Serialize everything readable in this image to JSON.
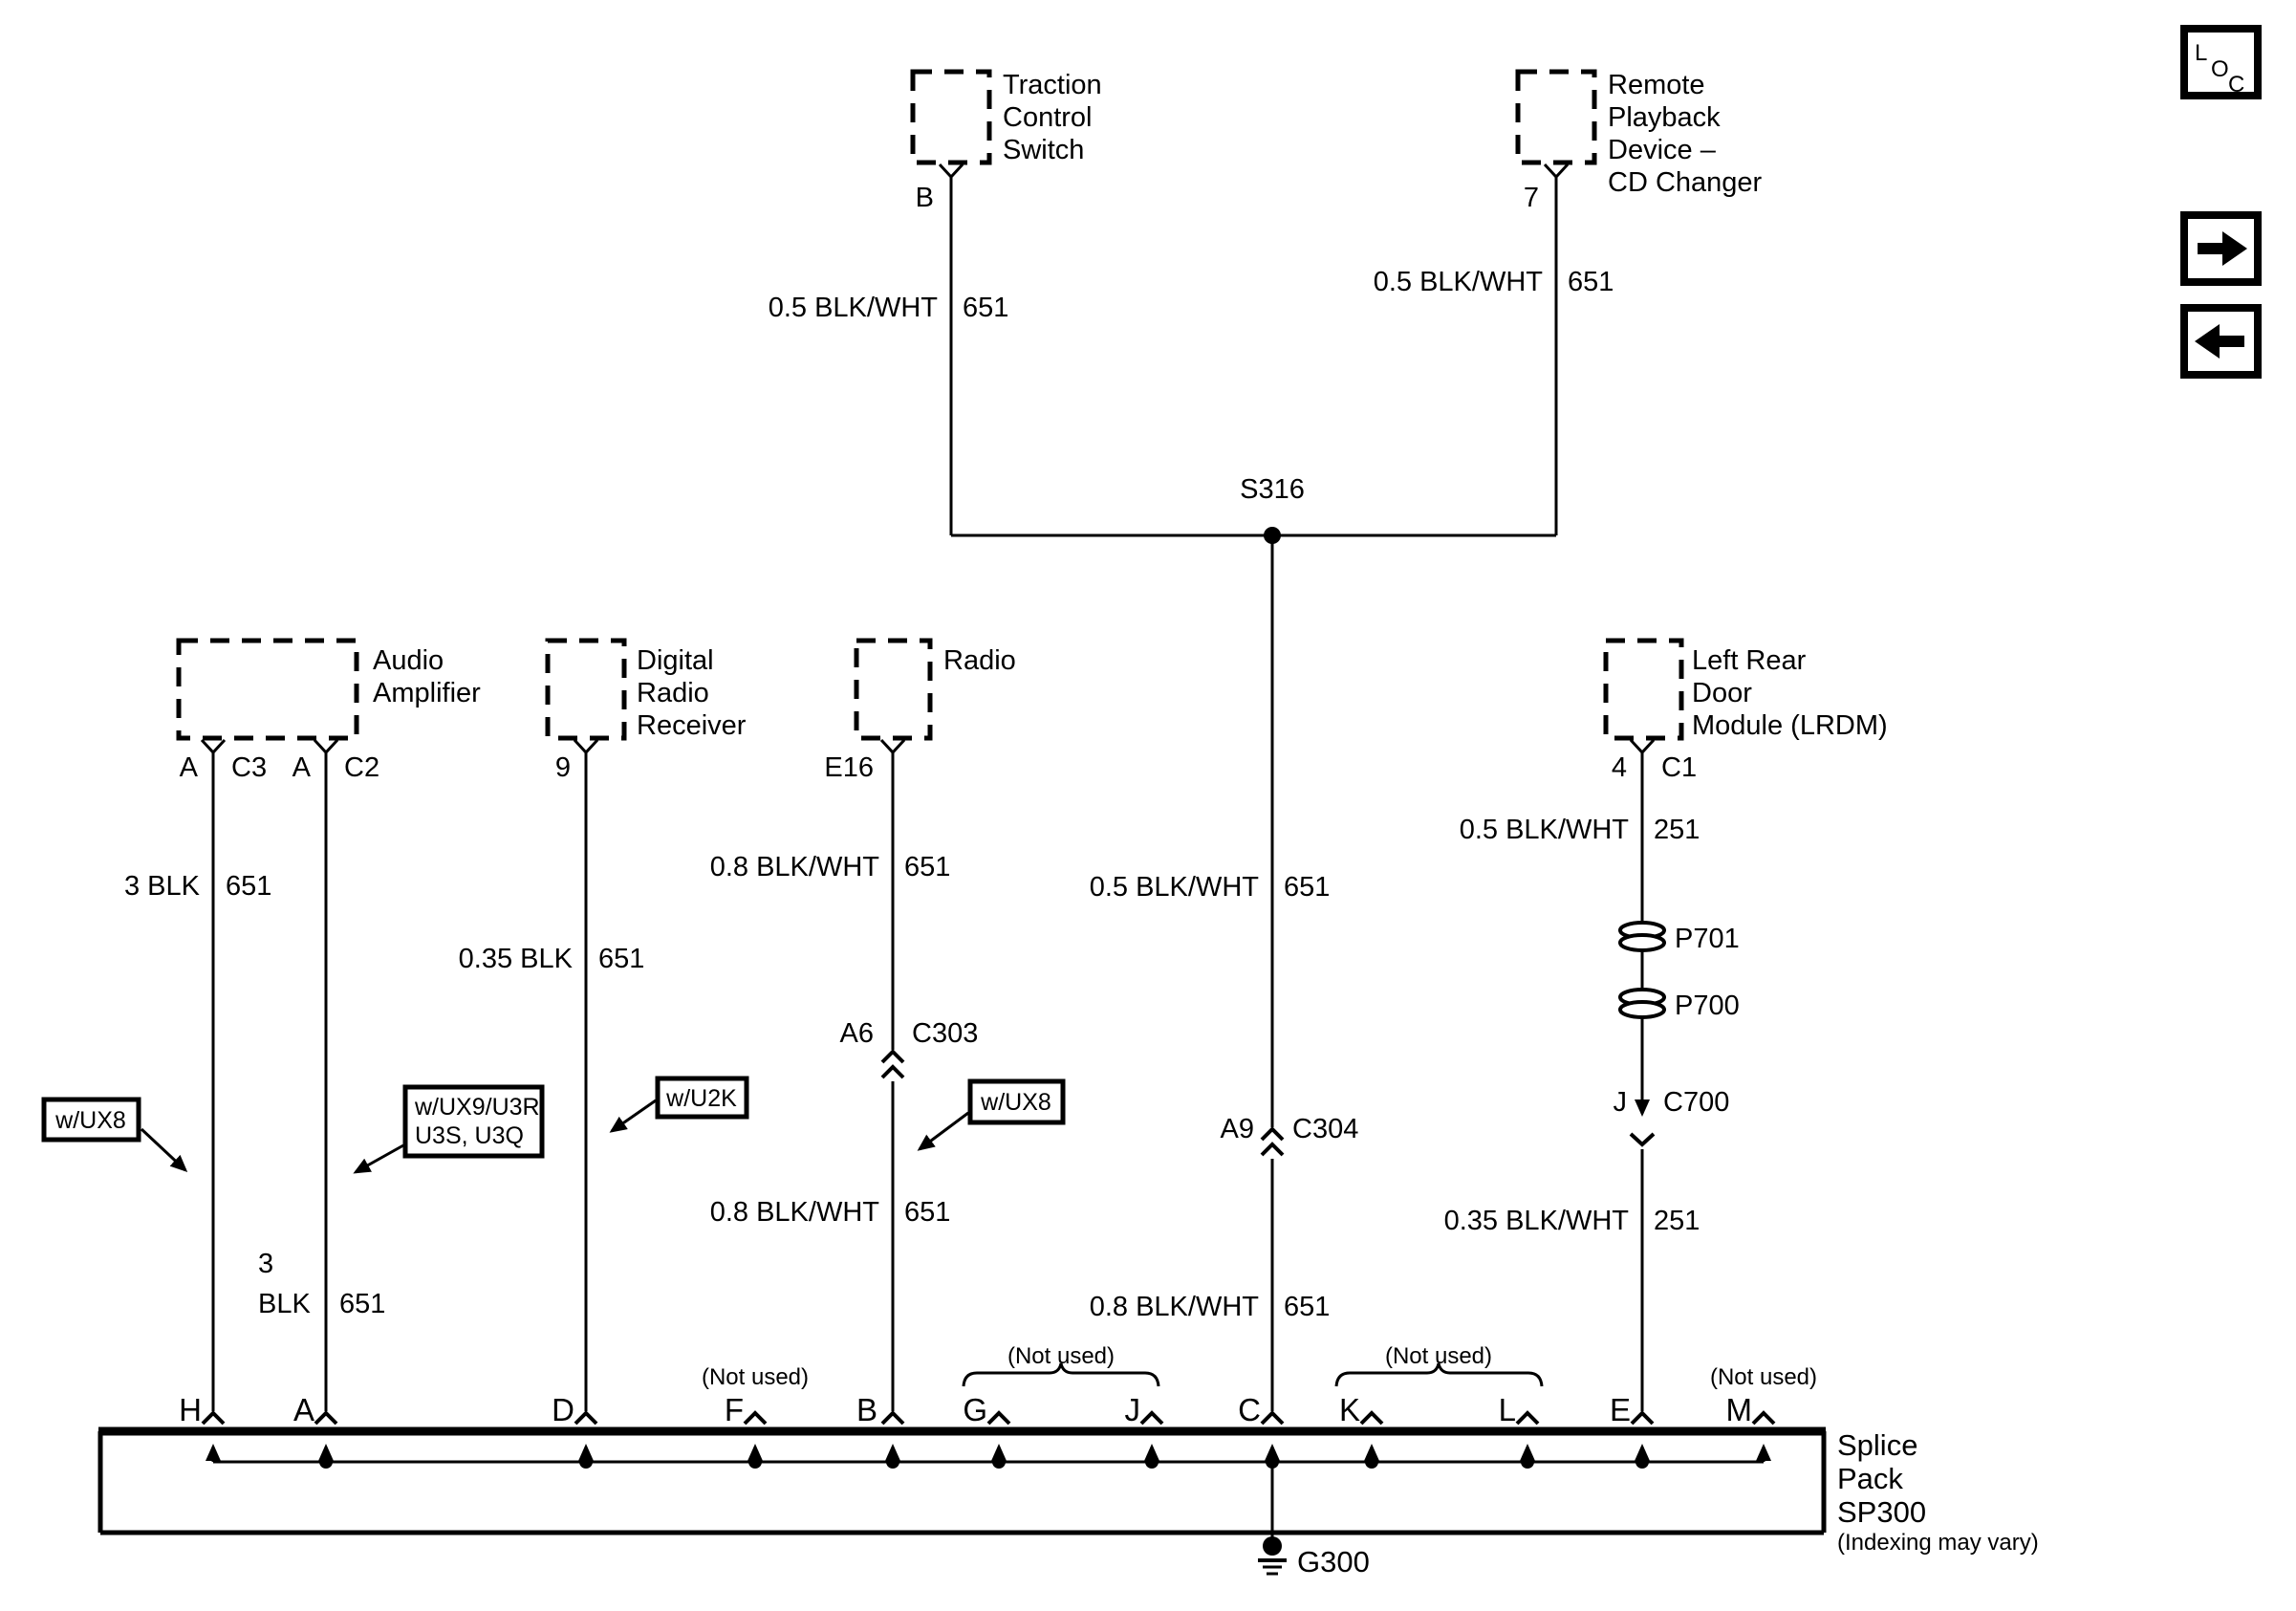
{
  "palette": {
    "ink": "#000000",
    "paper": "#ffffff"
  },
  "nav": {
    "loc": {
      "l": "L",
      "o": "O",
      "c": "C"
    }
  },
  "devices": {
    "traction": {
      "lines": [
        "Traction",
        "Control",
        "Switch"
      ],
      "pin": "B",
      "wire": {
        "gauge": "0.5 BLK/WHT",
        "circuit": "651"
      }
    },
    "remote": {
      "lines": [
        "Remote",
        "Playback",
        "Device –",
        "CD Changer"
      ],
      "pin": "7",
      "wire": {
        "gauge": "0.5 BLK/WHT",
        "circuit": "651"
      }
    },
    "amp": {
      "lines": [
        "Audio",
        "Amplifier"
      ],
      "pin1": "A",
      "conn1": "C3",
      "pin2": "A",
      "conn2": "C2",
      "wire1": {
        "gauge": "3 BLK",
        "circuit": "651"
      },
      "wire2": {
        "gauge1": "3",
        "gauge2": "BLK",
        "circuit": "651"
      }
    },
    "digital": {
      "lines": [
        "Digital",
        "Radio",
        "Receiver"
      ],
      "pin": "9",
      "wire": {
        "gauge": "0.35 BLK",
        "circuit": "651"
      }
    },
    "radio": {
      "lines": [
        "Radio"
      ],
      "pin": "E16",
      "wire_upper": {
        "gauge": "0.8 BLK/WHT",
        "circuit": "651"
      },
      "connector": {
        "pin": "A6",
        "name": "C303"
      },
      "wire_lower": {
        "gauge": "0.8 BLK/WHT",
        "circuit": "651"
      }
    },
    "lrdm": {
      "lines": [
        "Left Rear",
        "Door",
        "Module (LRDM)"
      ],
      "pin": "4",
      "conn": "C1",
      "wire_upper": {
        "gauge": "0.5 BLK/WHT",
        "circuit": "251"
      },
      "pass1": "P701",
      "pass2": "P700",
      "connector": {
        "pin": "J",
        "name": "C700"
      },
      "wire_lower": {
        "gauge": "0.35 BLK/WHT",
        "circuit": "251"
      }
    }
  },
  "s316": {
    "label": "S316",
    "wire_mid": {
      "gauge": "0.5 BLK/WHT",
      "circuit": "651"
    },
    "connector": {
      "pin": "A9",
      "name": "C304"
    },
    "wire_lower": {
      "gauge": "0.8 BLK/WHT",
      "circuit": "651"
    }
  },
  "tags": {
    "ux8_left": "w/UX8",
    "ux9_line1": "w/UX9/U3R,",
    "ux9_line2": "U3S, U3Q",
    "u2k": "w/U2K",
    "ux8_right": "w/UX8"
  },
  "splice_pack": {
    "terminals": [
      "H",
      "A",
      "D",
      "F",
      "B",
      "G",
      "J",
      "C",
      "K",
      "L",
      "E",
      "M"
    ],
    "not_used": "(Not used)",
    "title_lines": [
      "Splice",
      "Pack",
      "SP300"
    ],
    "note": "(Indexing may vary)",
    "ground": "G300"
  }
}
